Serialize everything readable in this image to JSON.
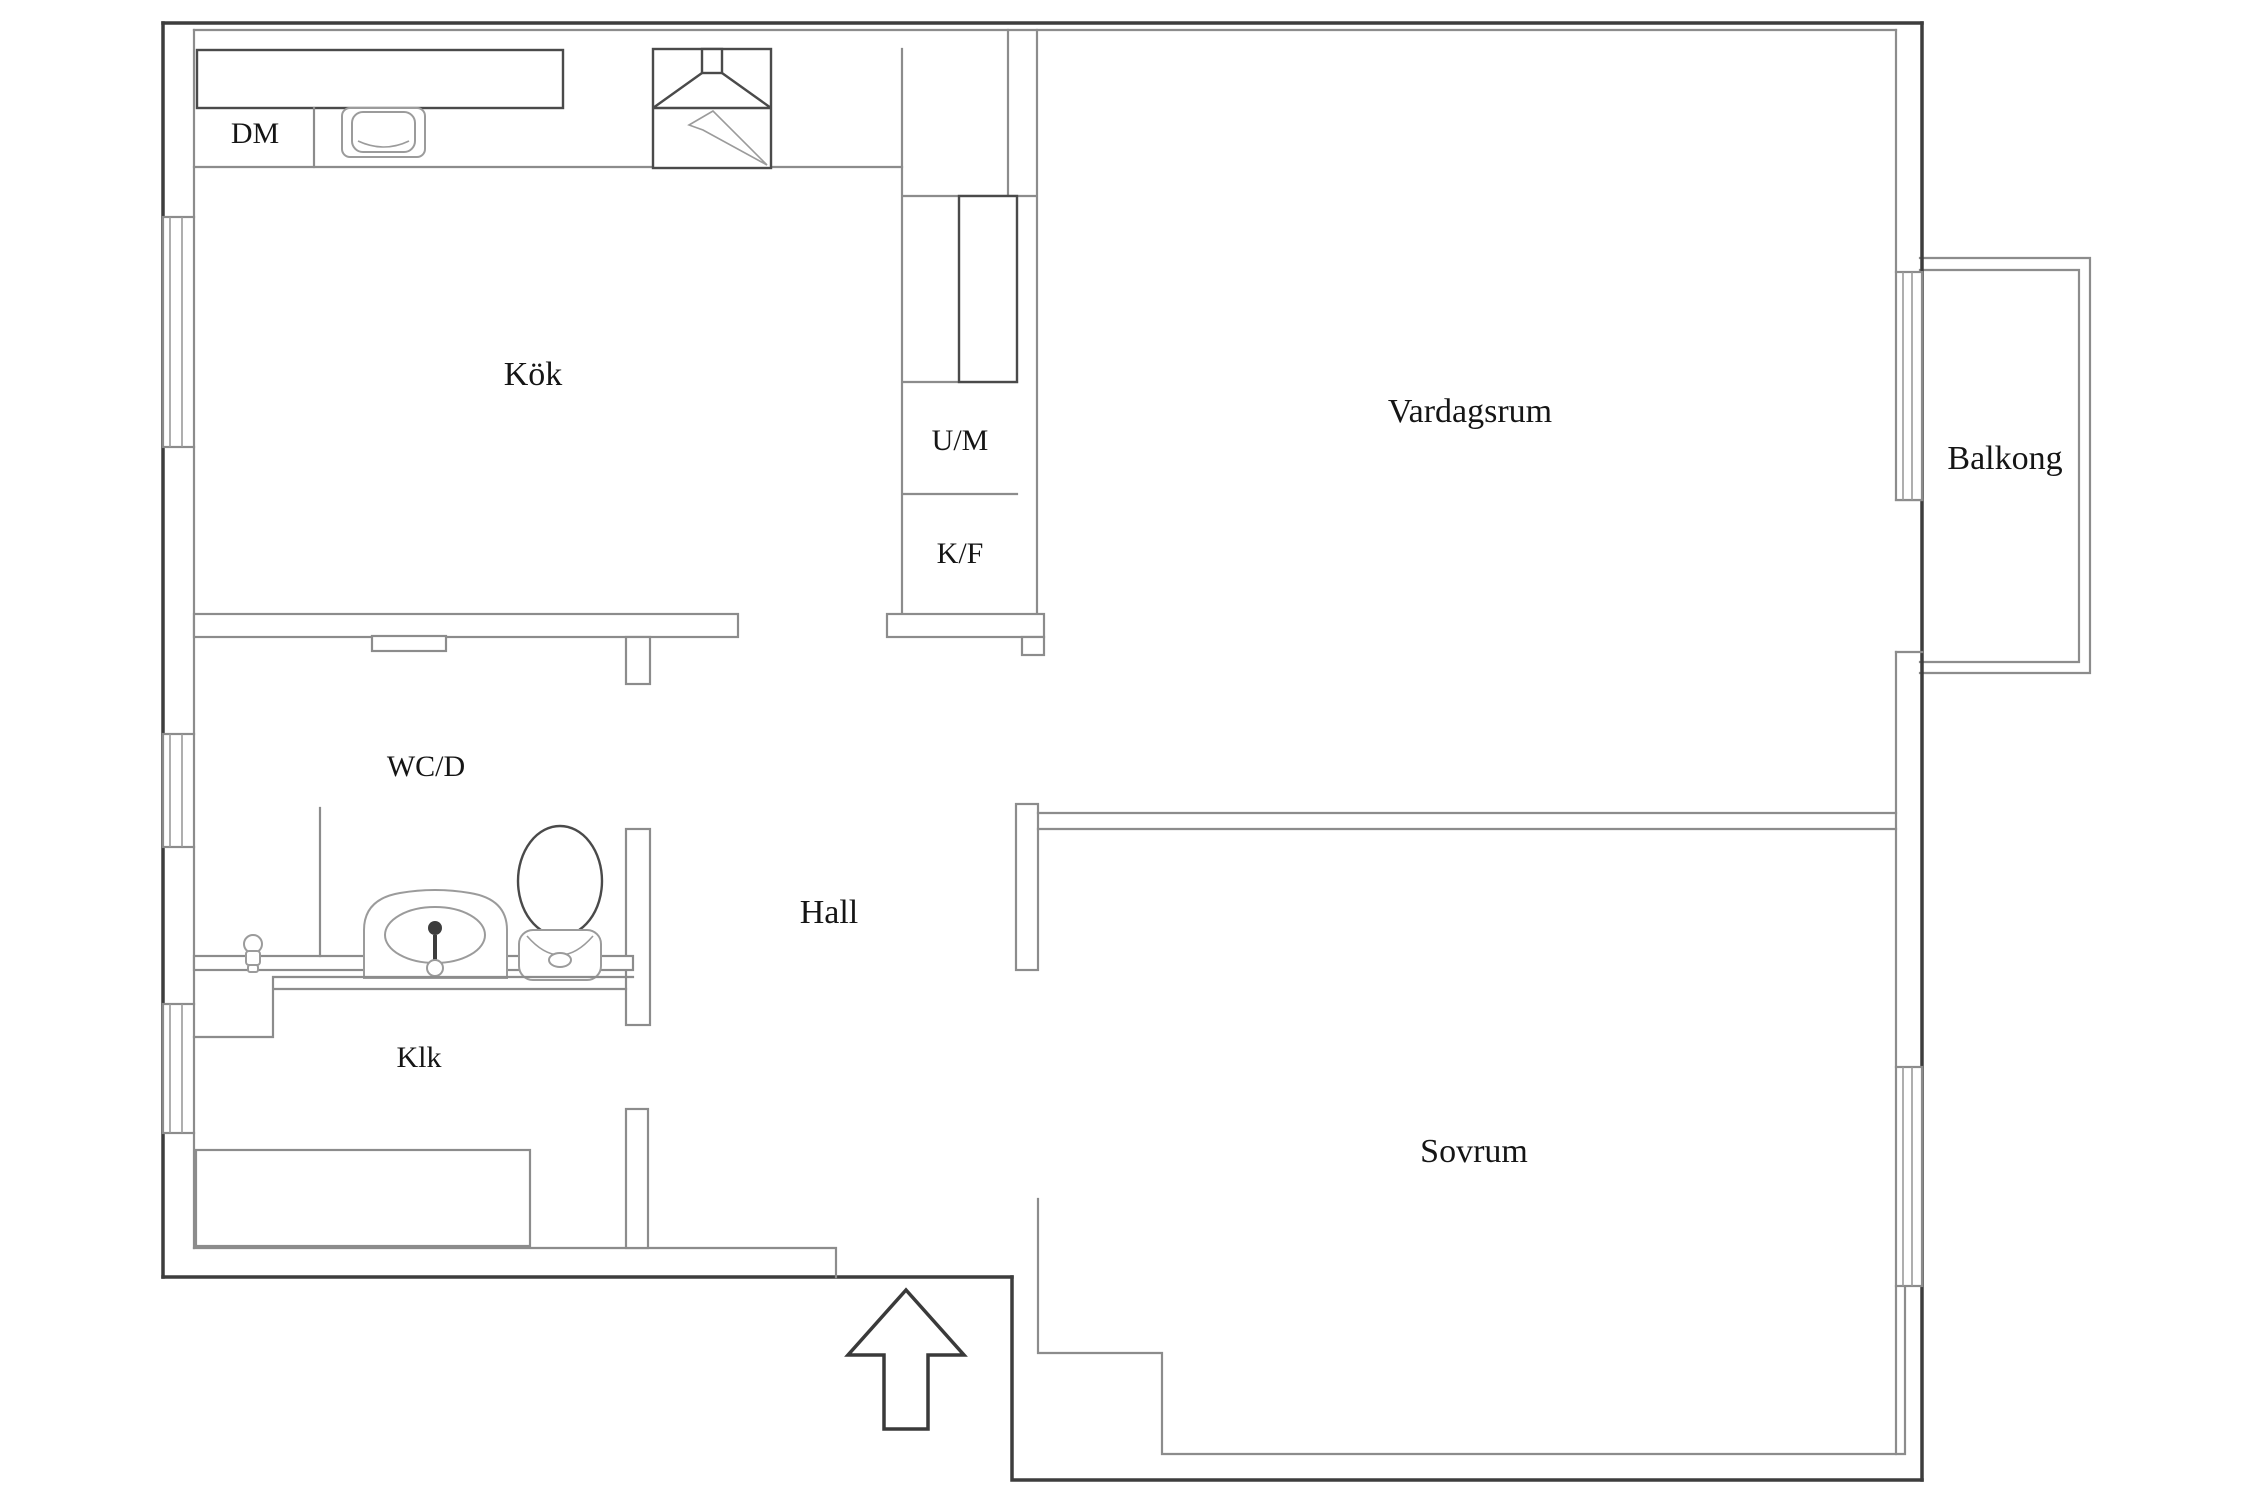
{
  "document": {
    "type": "floor-plan",
    "background": "#ffffff"
  },
  "palette": {
    "outer_wall": "#3d3d3d",
    "inner_wall": "#8c8c8c",
    "fixture_line": "#9b9b9b",
    "text": "#151515"
  },
  "labels": {
    "dishwasher": "DM",
    "kitchen": "Kök",
    "washing_machine": "U/M",
    "fridge_freezer": "K/F",
    "living_room": "Vardagsrum",
    "balcony": "Balkong",
    "bathroom": "WC/D",
    "hall": "Hall",
    "closet": "Klk",
    "bedroom": "Sovrum"
  }
}
